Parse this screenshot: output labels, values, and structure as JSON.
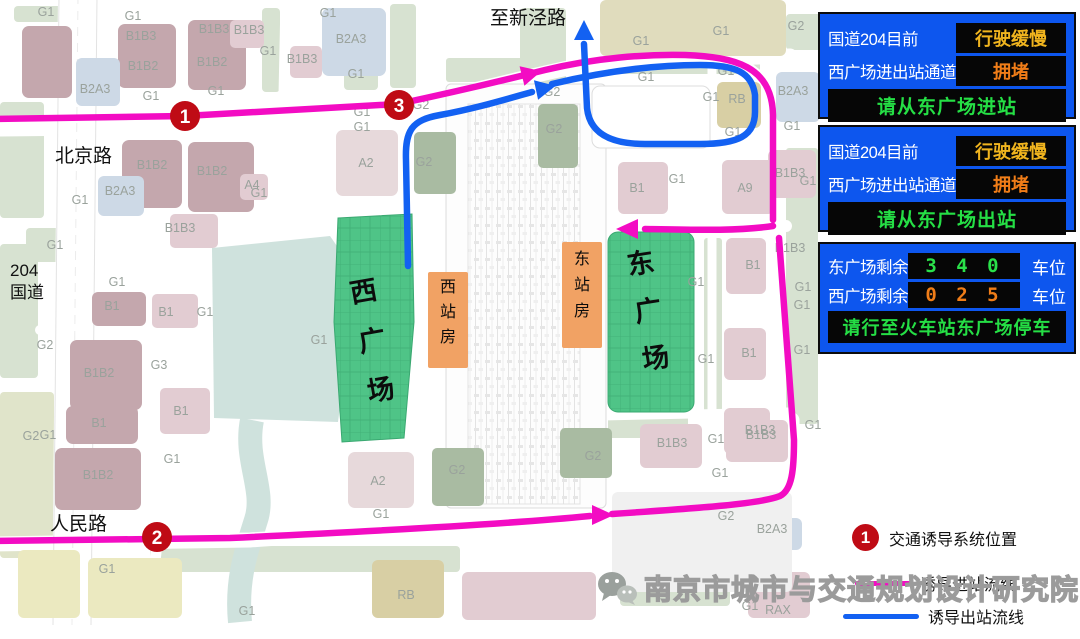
{
  "colors": {
    "route_in": "#f30cc3",
    "route_out": "#1361f2",
    "marker_red": "#bf0b15",
    "board_bg": "#0d56ee",
    "value_yellow": "#f0b41e",
    "value_orange": "#f07d18",
    "value_green": "#2ae04a",
    "plaza_green": "#4fc487",
    "station_orange": "#f1a264"
  },
  "map": {
    "road_labels": {
      "zhixinjing": "至新泾路",
      "beijing": "北京路",
      "g204_line1": "204",
      "g204_line2": "国道",
      "renmin": "人民路"
    },
    "places": {
      "west_plaza": "西广场",
      "east_plaza": "东广场",
      "west_station": "西站房",
      "east_station": "东站房"
    },
    "markers": [
      {
        "n": "1",
        "x": 185,
        "y": 116
      },
      {
        "n": "2",
        "x": 157,
        "y": 537
      },
      {
        "n": "3",
        "x": 399,
        "y": 105
      }
    ],
    "block_labels": [
      {
        "t": "G1",
        "x": 46,
        "y": 16
      },
      {
        "t": "G1",
        "x": 133,
        "y": 20
      },
      {
        "t": "B1B3",
        "x": 141,
        "y": 40
      },
      {
        "t": "B1B2",
        "x": 143,
        "y": 70
      },
      {
        "t": "B1B3",
        "x": 214,
        "y": 33
      },
      {
        "t": "B1B2",
        "x": 212,
        "y": 66
      },
      {
        "t": "B1B3",
        "x": 249,
        "y": 34
      },
      {
        "t": "G1",
        "x": 268,
        "y": 55
      },
      {
        "t": "B1B3",
        "x": 302,
        "y": 63
      },
      {
        "t": "B2A3",
        "x": 95,
        "y": 93
      },
      {
        "t": "G1",
        "x": 151,
        "y": 100
      },
      {
        "t": "G1",
        "x": 216,
        "y": 95
      },
      {
        "t": "B2A3",
        "x": 351,
        "y": 43
      },
      {
        "t": "G1",
        "x": 328,
        "y": 17
      },
      {
        "t": "G1",
        "x": 356,
        "y": 78
      },
      {
        "t": "G2",
        "x": 552,
        "y": 96
      },
      {
        "t": "G2",
        "x": 421,
        "y": 109
      },
      {
        "t": "G1",
        "x": 362,
        "y": 116
      },
      {
        "t": "G1",
        "x": 362,
        "y": 131
      },
      {
        "t": "A2",
        "x": 366,
        "y": 167
      },
      {
        "t": "G2",
        "x": 424,
        "y": 166
      },
      {
        "t": "G2",
        "x": 554,
        "y": 133
      },
      {
        "t": "G1",
        "x": 641,
        "y": 45
      },
      {
        "t": "G1",
        "x": 721,
        "y": 35
      },
      {
        "t": "G2",
        "x": 796,
        "y": 30
      },
      {
        "t": "G1",
        "x": 646,
        "y": 81
      },
      {
        "t": "G1",
        "x": 726,
        "y": 75
      },
      {
        "t": "G1",
        "x": 711,
        "y": 101
      },
      {
        "t": "RB",
        "x": 737,
        "y": 103
      },
      {
        "t": "B2A3",
        "x": 793,
        "y": 95
      },
      {
        "t": "G1",
        "x": 792,
        "y": 130
      },
      {
        "t": "G1",
        "x": 733,
        "y": 136
      },
      {
        "t": "B1",
        "x": 637,
        "y": 192
      },
      {
        "t": "G1",
        "x": 677,
        "y": 183
      },
      {
        "t": "A9",
        "x": 745,
        "y": 192
      },
      {
        "t": "B1B3",
        "x": 790,
        "y": 177
      },
      {
        "t": "G1",
        "x": 808,
        "y": 185
      },
      {
        "t": "A4",
        "x": 252,
        "y": 189
      },
      {
        "t": "G1",
        "x": 259,
        "y": 197
      },
      {
        "t": "B1B2",
        "x": 152,
        "y": 169
      },
      {
        "t": "B1B2",
        "x": 212,
        "y": 175
      },
      {
        "t": "B2A3",
        "x": 120,
        "y": 195
      },
      {
        "t": "G1",
        "x": 80,
        "y": 204
      },
      {
        "t": "B1B3",
        "x": 180,
        "y": 232
      },
      {
        "t": "G1",
        "x": 55,
        "y": 249
      },
      {
        "t": "G1",
        "x": 117,
        "y": 286
      },
      {
        "t": "B1",
        "x": 112,
        "y": 310
      },
      {
        "t": "B1",
        "x": 166,
        "y": 316
      },
      {
        "t": "G1",
        "x": 205,
        "y": 316
      },
      {
        "t": "G2",
        "x": 45,
        "y": 349
      },
      {
        "t": "B1B2",
        "x": 99,
        "y": 377
      },
      {
        "t": "G3",
        "x": 159,
        "y": 369
      },
      {
        "t": "B1",
        "x": 181,
        "y": 415
      },
      {
        "t": "G1",
        "x": 319,
        "y": 344
      },
      {
        "t": "B1",
        "x": 99,
        "y": 427
      },
      {
        "t": "G1",
        "x": 172,
        "y": 463
      },
      {
        "t": "B1B2",
        "x": 98,
        "y": 479
      },
      {
        "t": "G2",
        "x": 31,
        "y": 440
      },
      {
        "t": "G1",
        "x": 48,
        "y": 439
      },
      {
        "t": "G1",
        "x": 107,
        "y": 573
      },
      {
        "t": "G1",
        "x": 247,
        "y": 615
      },
      {
        "t": "B1B3",
        "x": 790,
        "y": 252
      },
      {
        "t": "B1",
        "x": 753,
        "y": 269
      },
      {
        "t": "G1",
        "x": 696,
        "y": 286
      },
      {
        "t": "G1",
        "x": 803,
        "y": 291
      },
      {
        "t": "G1",
        "x": 802,
        "y": 309
      },
      {
        "t": "G1",
        "x": 706,
        "y": 363
      },
      {
        "t": "B1",
        "x": 749,
        "y": 357
      },
      {
        "t": "G1",
        "x": 802,
        "y": 354
      },
      {
        "t": "B1B3",
        "x": 760,
        "y": 434
      },
      {
        "t": "G1",
        "x": 813,
        "y": 429
      },
      {
        "t": "A2",
        "x": 378,
        "y": 485
      },
      {
        "t": "G2",
        "x": 457,
        "y": 474
      },
      {
        "t": "G1",
        "x": 381,
        "y": 518
      },
      {
        "t": "RB",
        "x": 406,
        "y": 599
      },
      {
        "t": "G2",
        "x": 593,
        "y": 460
      },
      {
        "t": "B1B3",
        "x": 672,
        "y": 447
      },
      {
        "t": "G1",
        "x": 716,
        "y": 443
      },
      {
        "t": "B1B3",
        "x": 761,
        "y": 439
      },
      {
        "t": "G1",
        "x": 720,
        "y": 477
      },
      {
        "t": "G2",
        "x": 726,
        "y": 520
      },
      {
        "t": "B2A3",
        "x": 772,
        "y": 533
      },
      {
        "t": "RAX",
        "x": 778,
        "y": 614
      },
      {
        "t": "G1",
        "x": 750,
        "y": 610
      }
    ]
  },
  "boards": [
    {
      "rows": [
        {
          "label": "国道204目前",
          "value": "行驶缓慢",
          "color": "#f0b41e"
        },
        {
          "label": "西广场进出站通道",
          "value": "拥堵",
          "color": "#f07d18"
        }
      ],
      "message": "请从东广场进站"
    },
    {
      "rows": [
        {
          "label": "国道204目前",
          "value": "行驶缓慢",
          "color": "#f0b41e"
        },
        {
          "label": "西广场进出站通道",
          "value": "拥堵",
          "color": "#f07d18"
        }
      ],
      "message": "请从东广场出站"
    },
    {
      "rows": [
        {
          "label": "东广场剩余",
          "value": "3 4 0",
          "unit": "车位",
          "color": "#2ae04a"
        },
        {
          "label": "西广场剩余",
          "value": "0 2 5",
          "unit": "车位",
          "color": "#f07d18"
        }
      ],
      "message": "请行至火车站东广场停车"
    }
  ],
  "legend": {
    "marker_number": "1",
    "marker_label": "交通诱导系统位置",
    "in_label": "诱导进站流线",
    "out_label": "诱导出站流线"
  },
  "watermark": "南京市城市与交通规划设计研究院"
}
